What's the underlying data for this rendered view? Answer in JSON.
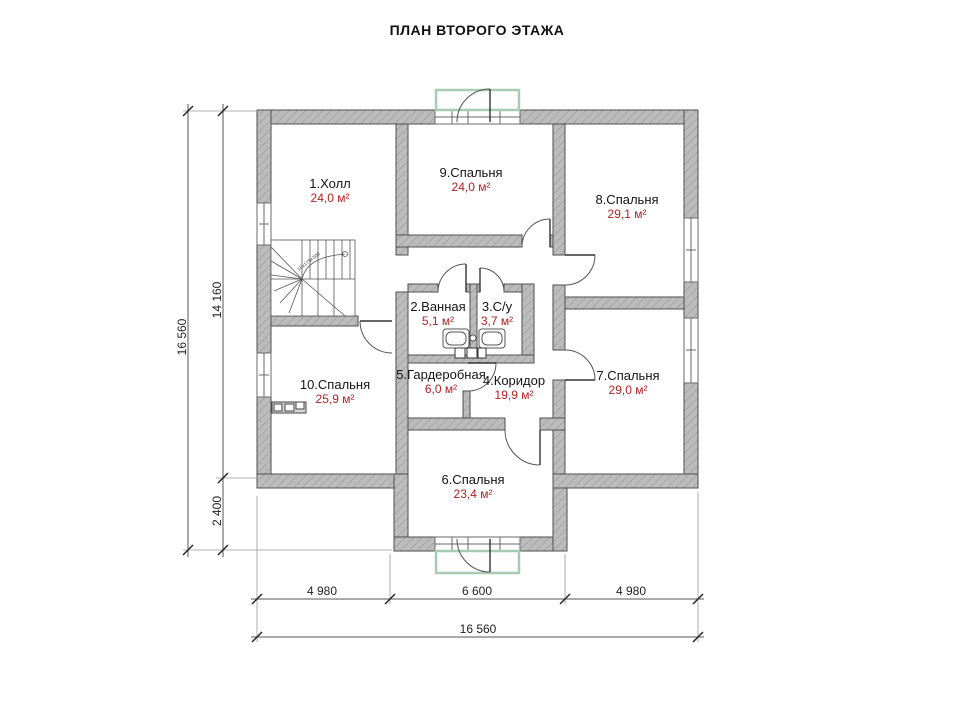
{
  "title": "ПЛАН ВТОРОГО ЭТАЖА",
  "rooms": [
    {
      "name": "1.Холл",
      "area": "24,0 м²"
    },
    {
      "name": "2.Ванная",
      "area": "5,1 м²"
    },
    {
      "name": "3.С/у",
      "area": "3,7 м²"
    },
    {
      "name": "4.Коридор",
      "area": "19,9 м²"
    },
    {
      "name": "5.Гардеробная",
      "area": "6,0 м²"
    },
    {
      "name": "6.Спальня",
      "area": "23,4 м²"
    },
    {
      "name": "7.Спальня",
      "area": "29,0 м²"
    },
    {
      "name": "8.Спальня",
      "area": "29,1 м²"
    },
    {
      "name": "9.Спальня",
      "area": "24,0 м²"
    },
    {
      "name": "10.Спальня",
      "area": "25,9 м²"
    }
  ],
  "dimensions": {
    "left_total": "16 560",
    "left_main": "14 160",
    "left_lower": "2 400",
    "bottom_left": "4 980",
    "bottom_center": "6 600",
    "bottom_right": "4 980",
    "bottom_total": "16 560"
  },
  "stairs_note": "15x175x300",
  "colors": {
    "wall_fill": "#bcbcbc",
    "wall_outline": "#4f4f4f",
    "area_text": "#b22222",
    "balcony_outline": "#a8cbb4",
    "dimension_line": "#555555",
    "text": "#111111"
  }
}
